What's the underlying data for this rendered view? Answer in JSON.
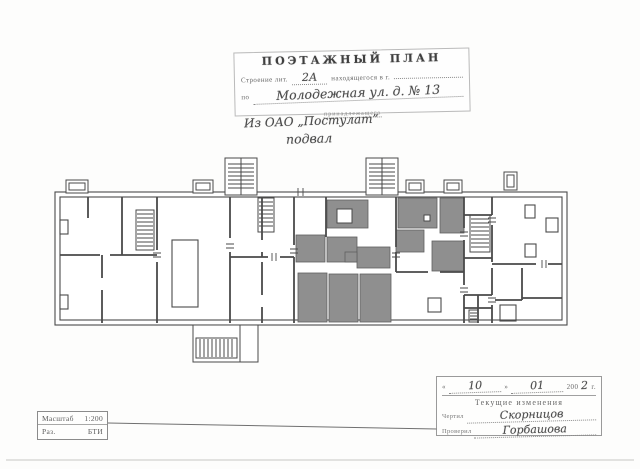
{
  "header_stamp": {
    "title": "ПОЭТАЖНЫЙ ПЛАН",
    "building_label": "Строение лит.",
    "building_value": "2А",
    "located_label": "находящегося в г.",
    "street_label": "по",
    "street_value": "Молодежная ул. д. № 13",
    "belonging_label": "принадлежащего",
    "owner_value": "Из ОАО „Постулат”",
    "floor_value": "подвал"
  },
  "revision_stamp": {
    "quote_open": "«",
    "day": "10",
    "quote_close": "»",
    "month": "01",
    "year_printed": "200",
    "year_digit": "2",
    "year_suffix": "г.",
    "title": "Текущие изменения",
    "drafted_label": "Чертил",
    "drafted_value": "Скорницов",
    "checked_label": "Проверил",
    "checked_value": "Горбашова"
  },
  "scale_stamp": {
    "scale_label": "Масштаб",
    "scale_value": "1:200",
    "org_label": "Раз.",
    "org_value": "БТИ"
  },
  "colors": {
    "ink": "#4a4a4a",
    "room_fill": "#8f8f8f",
    "paper": "#fdfdfc",
    "stamp_ink": "#555555"
  }
}
